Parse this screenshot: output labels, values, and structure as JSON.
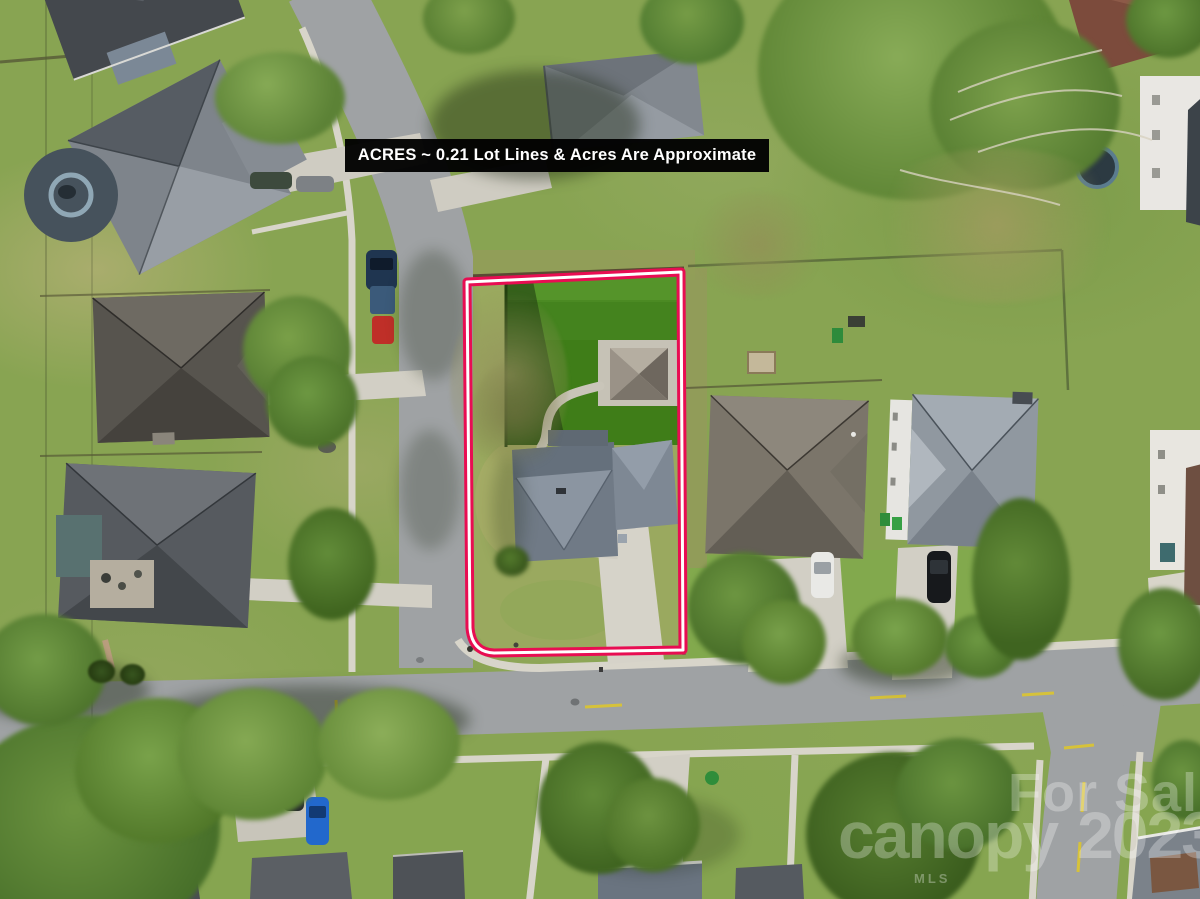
{
  "overlay": {
    "banner": {
      "text": "ACRES ~ 0.21 Lot Lines & Acres Are Approximate",
      "bg_color": "#000000",
      "text_color": "#ffffff"
    },
    "watermark": {
      "line1": "For Sale",
      "brand": "canopy",
      "brand_sub": "MLS",
      "year": "2023",
      "color": "rgba(255,255,255,0.29)"
    },
    "lot_outline": {
      "outer_color": "#e80d52",
      "inner_color": "#ffffff"
    }
  },
  "palette": {
    "grass": "#88a452",
    "turf_backyard": "#3f7d18",
    "road": "#9fa2a4",
    "sidewalk": "#d8d5ca",
    "subject_roof": "#79838f",
    "accent_pink": "#e80d52"
  }
}
